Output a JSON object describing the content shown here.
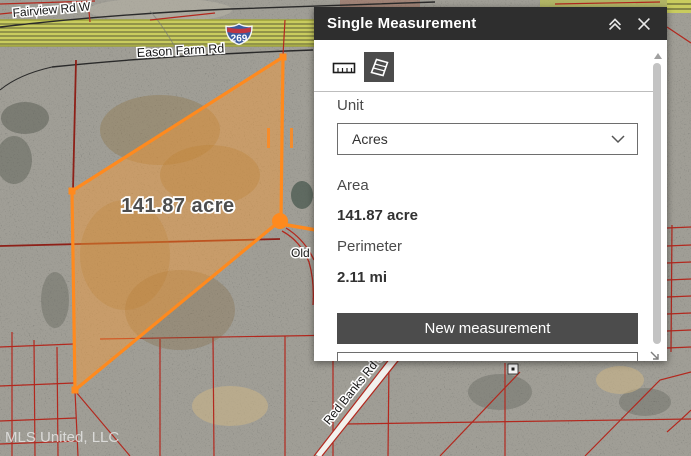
{
  "panel": {
    "title": "Single Measurement",
    "unit_label": "Unit",
    "unit_value": "Acres",
    "area_label": "Area",
    "area_value": "141.87 acre",
    "perimeter_label": "Perimeter",
    "perimeter_value": "2.11 mi",
    "new_measurement": "New measurement"
  },
  "map": {
    "road_fairview": "Fairview Rd W",
    "road_eason": "Eason Farm Rd",
    "interstate_shield": "269",
    "road_old": "Old",
    "road_red_banks": "Red Banks Rd S",
    "measurement_label": "141.87 acre",
    "watermark": "MLS United, LLC"
  },
  "colors": {
    "measure_orange": "#ff8a1e",
    "parcel_red": "#b3281e",
    "parcel_maroon": "#8e2018",
    "highway_yellow": "#c9cc5e",
    "shield_blue": "#3a5ba0",
    "shield_red": "#bf3541",
    "header_bg": "#2e2e2e",
    "button_bg": "#4c4c4c"
  }
}
